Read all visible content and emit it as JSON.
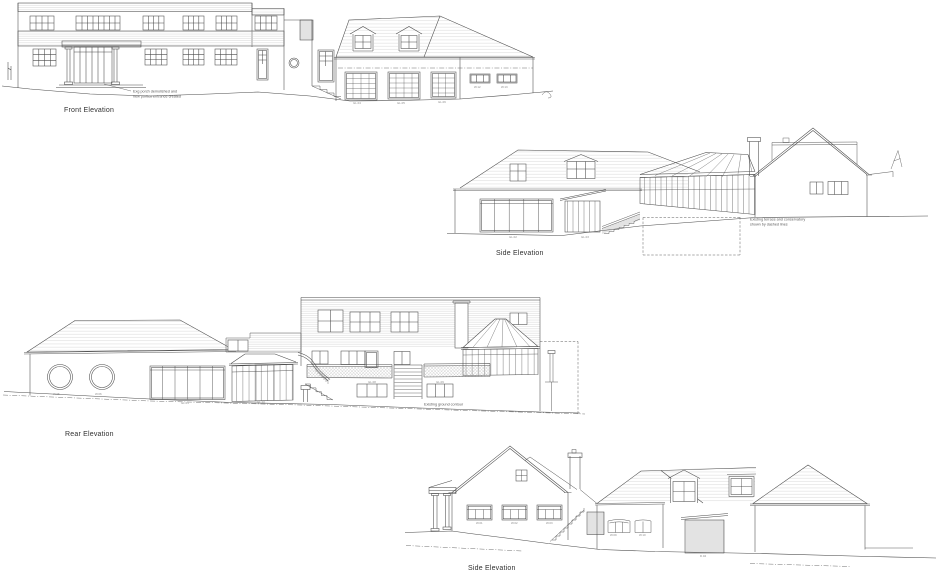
{
  "sheet": {
    "background": "#ffffff",
    "line_color": "#4a4a4a",
    "hatch_color": "#c7c7c7",
    "title_color": "#303030"
  },
  "front": {
    "title": "Front Elevation",
    "annotation_line1": "Exg porch demolished and",
    "annotation_line2": "new portico entrance created",
    "codes": [
      "GL.04",
      "GL.05",
      "GL.06",
      "W.12",
      "W.13"
    ]
  },
  "side_upper": {
    "title": "Side Elevation",
    "annotation_line1": "Existing terrace and conservatory",
    "annotation_line2": "shown by dashed lines",
    "codes": [
      "GL.02",
      "GL.03"
    ]
  },
  "rear": {
    "title": "Rear Elevation",
    "annotation": "Existing ground contour",
    "codes": [
      "W.05",
      "W.06",
      "GL.01",
      "GL.10",
      "GL.08",
      "GL.09"
    ]
  },
  "side_lower": {
    "title": "Side Elevation",
    "codes": [
      "W.01",
      "W.02",
      "W.03",
      "W.09",
      "W.10",
      "D.04"
    ]
  }
}
